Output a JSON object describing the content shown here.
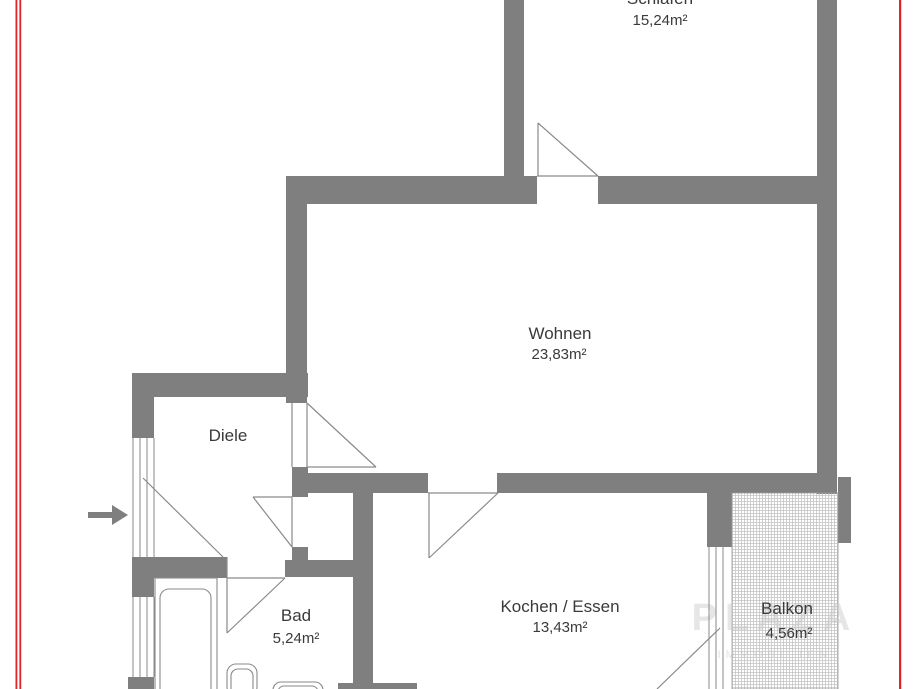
{
  "colors": {
    "wall": "#7f7f7f",
    "line": "#8a8a8a",
    "text": "#3a3a3a",
    "red": "#e32227",
    "hatch": "#c4c4c4",
    "watermark": "#c9c9c9"
  },
  "rooms": {
    "schlafen": {
      "name": "Schlafen",
      "area": "15,24m²"
    },
    "wohnen": {
      "name": "Wohnen",
      "area": "23,83m²"
    },
    "diele": {
      "name": "Diele"
    },
    "bad": {
      "name": "Bad",
      "area": "5,24m²"
    },
    "kochen": {
      "name": "Kochen / Essen",
      "area": "13,43m²"
    },
    "balkon": {
      "name": "Balkon",
      "area": "4,56m²"
    }
  },
  "watermark": {
    "large": "PLAZA",
    "small": "IMMOBILIEN"
  }
}
